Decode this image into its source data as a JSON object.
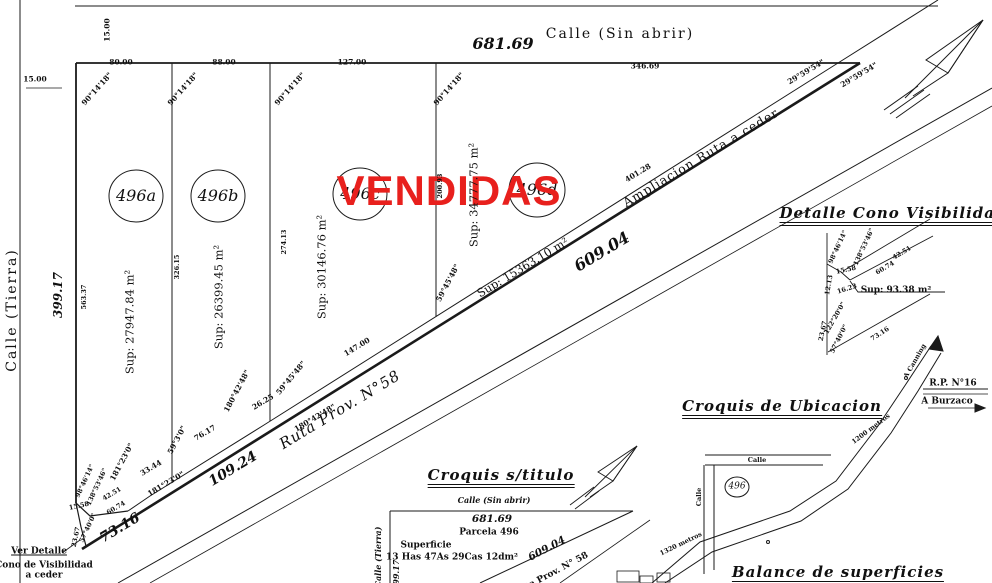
{
  "stamp_color": "#e8201d",
  "line_color": "#1a1a1a",
  "labels": [
    {
      "n": "dim-street-width-vert",
      "t": "15.00",
      "x": 107,
      "y": 30,
      "r": -90,
      "c": "dim"
    },
    {
      "n": "dim-street-width-left",
      "t": "15.00",
      "x": 35,
      "y": 79,
      "r": 0,
      "c": "dim"
    },
    {
      "n": "dim-frontage-496a",
      "t": "80.00",
      "x": 121,
      "y": 62,
      "r": 0,
      "c": "dim"
    },
    {
      "n": "angle-496a",
      "t": "90°14'18\"",
      "x": 97,
      "y": 89,
      "r": -48,
      "c": "dim"
    },
    {
      "n": "dim-frontage-496b",
      "t": "88.00",
      "x": 224,
      "y": 62,
      "r": 0,
      "c": "dim"
    },
    {
      "n": "angle-496b",
      "t": "90°14'18\"",
      "x": 183,
      "y": 89,
      "r": -48,
      "c": "dim"
    },
    {
      "n": "dim-frontage-496c",
      "t": "127.00",
      "x": 352,
      "y": 62,
      "r": 0,
      "c": "dim"
    },
    {
      "n": "angle-496c",
      "t": "90°14'18\"",
      "x": 290,
      "y": 89,
      "r": -48,
      "c": "dim"
    },
    {
      "n": "angle-496d",
      "t": "90°14'18\"",
      "x": 449,
      "y": 89,
      "r": -48,
      "c": "dim"
    },
    {
      "n": "dim-frontage-496d",
      "t": "346.69",
      "x": 645,
      "y": 66,
      "r": 0,
      "c": "dim"
    },
    {
      "n": "dim-street-total",
      "t": "681.69",
      "x": 503,
      "y": 44,
      "r": 0,
      "c": "numlg"
    },
    {
      "n": "street-name-top",
      "t": "Calle (Sin abrir)",
      "x": 620,
      "y": 34,
      "r": 0,
      "c": "street"
    },
    {
      "n": "angle-route-1",
      "t": "29°59'54\"",
      "x": 806,
      "y": 72,
      "r": -31,
      "c": "dim"
    },
    {
      "n": "angle-route-2",
      "t": "29°59'54\"",
      "x": 859,
      "y": 75,
      "r": -31,
      "c": "dim"
    },
    {
      "n": "street-name-left",
      "t": "Calle (Tierra)",
      "x": 12,
      "y": 310,
      "r": -90,
      "c": "street"
    },
    {
      "n": "dim-left-total",
      "t": "399.17",
      "x": 58,
      "y": 295,
      "r": -90,
      "c": "numsm"
    },
    {
      "n": "parcel-id-496a",
      "t": "496a",
      "x": 136,
      "y": 196,
      "r": 0,
      "c": "parcel"
    },
    {
      "n": "parcel-id-496b",
      "t": "496b",
      "x": 218,
      "y": 196,
      "r": 0,
      "c": "parcel"
    },
    {
      "n": "parcel-id-496c",
      "t": "496c",
      "x": 360,
      "y": 194,
      "r": 0,
      "c": "parcel"
    },
    {
      "n": "parcel-id-496d",
      "t": "496d",
      "x": 537,
      "y": 190,
      "r": 0,
      "c": "parcel"
    },
    {
      "n": "sold-stamp",
      "t": "VENDIDAS",
      "x": 449,
      "y": 191,
      "r": 0,
      "c": "stamp"
    },
    {
      "n": "dim-west-side",
      "t": "563.37",
      "x": 84,
      "y": 297,
      "r": -90,
      "c": "dimsm"
    },
    {
      "n": "area-496a",
      "t": "Sup: 27947.84 m²",
      "x": 130,
      "y": 322,
      "r": -90,
      "c": "sup"
    },
    {
      "n": "dim-div-ab",
      "t": "326.15",
      "x": 177,
      "y": 267,
      "r": -90,
      "c": "dimsm"
    },
    {
      "n": "area-496b",
      "t": "Sup: 26399.45 m²",
      "x": 219,
      "y": 297,
      "r": -90,
      "c": "sup"
    },
    {
      "n": "dim-div-bc",
      "t": "274.13",
      "x": 284,
      "y": 242,
      "r": -90,
      "c": "dimsm"
    },
    {
      "n": "area-496c",
      "t": "Sup: 30146.76 m²",
      "x": 322,
      "y": 267,
      "r": -90,
      "c": "sup"
    },
    {
      "n": "dim-div-cd",
      "t": "200.93",
      "x": 440,
      "y": 186,
      "r": -90,
      "c": "dimsm"
    },
    {
      "n": "area-496d",
      "t": "Sup: 34777.75 m²",
      "x": 474,
      "y": 195,
      "r": -90,
      "c": "sup"
    },
    {
      "n": "angle-div-cd",
      "t": "59°45'48\"",
      "x": 448,
      "y": 283,
      "r": -62,
      "c": "dim"
    },
    {
      "n": "angle-div-bc",
      "t": "59°45'48\"",
      "x": 291,
      "y": 378,
      "r": -50,
      "c": "dim"
    },
    {
      "n": "dim-diag-496d",
      "t": "401.28",
      "x": 638,
      "y": 173,
      "r": -31,
      "c": "dim"
    },
    {
      "n": "strip-name",
      "t": "Ampliacion Ruta a ceder",
      "x": 701,
      "y": 158,
      "r": -31,
      "c": "strip"
    },
    {
      "n": "area-strip",
      "t": "Sup: 15363.10 m²",
      "x": 523,
      "y": 268,
      "r": -31,
      "c": "sup"
    },
    {
      "n": "dim-route-edge",
      "t": "609.04",
      "x": 602,
      "y": 252,
      "r": -31,
      "c": "numlg"
    },
    {
      "n": "dim-diag-496c",
      "t": "147.00",
      "x": 357,
      "y": 347,
      "r": -31,
      "c": "dim"
    },
    {
      "n": "angle-bend-1",
      "t": "180°42'48\"",
      "x": 237,
      "y": 391,
      "r": -62,
      "c": "dim"
    },
    {
      "n": "dim-bend-seg",
      "t": "26.25",
      "x": 263,
      "y": 402,
      "r": -31,
      "c": "dim"
    },
    {
      "n": "angle-bend-2",
      "t": "180°42'48\"",
      "x": 315,
      "y": 418,
      "r": -31,
      "c": "dim"
    },
    {
      "n": "dim-diag-496b",
      "t": "76.17",
      "x": 205,
      "y": 433,
      "r": -31,
      "c": "dim"
    },
    {
      "n": "angle-div-ab-bottom",
      "t": "59°3'0\"",
      "x": 177,
      "y": 440,
      "r": -62,
      "c": "dim"
    },
    {
      "n": "dim-diag-496a",
      "t": "33.44",
      "x": 151,
      "y": 468,
      "r": -31,
      "c": "dim"
    },
    {
      "n": "angle-bend-3",
      "t": "181°23'0\"",
      "x": 122,
      "y": 462,
      "r": -62,
      "c": "dim"
    },
    {
      "n": "angle-bend-4",
      "t": "181°23'0\"",
      "x": 166,
      "y": 484,
      "r": -31,
      "c": "dim"
    },
    {
      "n": "dim-route-seg-2",
      "t": "109.24",
      "x": 233,
      "y": 469,
      "r": -31,
      "c": "nummd"
    },
    {
      "n": "route-name",
      "t": "Ruta Prov. N°58",
      "x": 340,
      "y": 410,
      "r": -31,
      "c": "route"
    },
    {
      "n": "dim-route-seg-1",
      "t": "73.16",
      "x": 120,
      "y": 528,
      "r": -31,
      "c": "nummd"
    },
    {
      "n": "cono-angle-1",
      "t": "98°46'14\"",
      "x": 85,
      "y": 481,
      "r": -65,
      "c": "dimsm"
    },
    {
      "n": "cono-angle-2",
      "t": "138°53'46\"",
      "x": 97,
      "y": 487,
      "r": -65,
      "c": "dimsm"
    },
    {
      "n": "cono-dim-1",
      "t": "15.58",
      "x": 79,
      "y": 506,
      "r": -12,
      "c": "dimsm"
    },
    {
      "n": "cono-dim-2",
      "t": "42.51",
      "x": 112,
      "y": 494,
      "r": -31,
      "c": "dimsm"
    },
    {
      "n": "cono-dim-3",
      "t": "60.74",
      "x": 116,
      "y": 508,
      "r": -31,
      "c": "dimsm"
    },
    {
      "n": "cono-angle-3",
      "t": "57°40'0\"",
      "x": 88,
      "y": 528,
      "r": -65,
      "c": "dimsm"
    },
    {
      "n": "cono-dim-4",
      "t": "23.67",
      "x": 76,
      "y": 537,
      "r": -78,
      "c": "dimsm"
    },
    {
      "n": "ver-detalle-line-1",
      "t": "Ver Detalle",
      "x": 39,
      "y": 552,
      "r": 0,
      "c": "smallbu"
    },
    {
      "n": "ver-detalle-line-2",
      "t": "Cono de Visibilidad",
      "x": 44,
      "y": 566,
      "r": 0,
      "c": "smallb"
    },
    {
      "n": "ver-detalle-line-3",
      "t": "a ceder",
      "x": 44,
      "y": 576,
      "r": 0,
      "c": "smallb"
    },
    {
      "n": "detail-title",
      "t": "Detalle Cono Visibilidad",
      "x": 893,
      "y": 216,
      "r": 0,
      "c": "title"
    },
    {
      "n": "detail-angle-1",
      "t": "98°46'14\"",
      "x": 838,
      "y": 247,
      "r": -65,
      "c": "dimsm"
    },
    {
      "n": "detail-angle-2",
      "t": "138°53'46\"",
      "x": 864,
      "y": 247,
      "r": -65,
      "c": "dimsm"
    },
    {
      "n": "detail-dim-1",
      "t": "42.51",
      "x": 902,
      "y": 253,
      "r": -31,
      "c": "dimsm"
    },
    {
      "n": "detail-dim-2",
      "t": "15.58",
      "x": 846,
      "y": 270,
      "r": -12,
      "c": "dimsm"
    },
    {
      "n": "detail-dim-3",
      "t": "60.74",
      "x": 885,
      "y": 268,
      "r": -31,
      "c": "dimsm"
    },
    {
      "n": "detail-dim-4",
      "t": "12.13",
      "x": 829,
      "y": 285,
      "r": -80,
      "c": "dimsm"
    },
    {
      "n": "detail-dim-5",
      "t": "16.23",
      "x": 847,
      "y": 289,
      "r": -18,
      "c": "dimsm"
    },
    {
      "n": "detail-area",
      "t": "Sup: 93.38 m²",
      "x": 896,
      "y": 291,
      "r": 0,
      "c": "smallb"
    },
    {
      "n": "detail-angle-3",
      "t": "122°20'0\"",
      "x": 835,
      "y": 318,
      "r": -60,
      "c": "dimsm"
    },
    {
      "n": "detail-dim-6",
      "t": "23.67",
      "x": 823,
      "y": 331,
      "r": -78,
      "c": "dimsm"
    },
    {
      "n": "detail-angle-4",
      "t": "57°40'0\"",
      "x": 839,
      "y": 339,
      "r": -63,
      "c": "dimsm"
    },
    {
      "n": "detail-dim-7",
      "t": "73.16",
      "x": 880,
      "y": 334,
      "r": -33,
      "c": "dimsm"
    },
    {
      "n": "location-title",
      "t": "Croquis de Ubicacion",
      "x": 782,
      "y": 409,
      "r": 0,
      "c": "title"
    },
    {
      "n": "road-a-canning",
      "t": "A Canning",
      "x": 915,
      "y": 361,
      "r": -60,
      "c": "dimsm"
    },
    {
      "n": "road-rp16",
      "t": "R.P. N°16",
      "x": 953,
      "y": 384,
      "r": 0,
      "c": "smallb"
    },
    {
      "n": "road-a-burzaco",
      "t": "A Burzaco",
      "x": 947,
      "y": 402,
      "r": 0,
      "c": "smallb"
    },
    {
      "n": "dist-1200",
      "t": "1200 metros",
      "x": 871,
      "y": 429,
      "r": -37,
      "c": "dimsm"
    },
    {
      "n": "dist-1320",
      "t": "1320 metros",
      "x": 681,
      "y": 544,
      "r": -26,
      "c": "dimsm"
    },
    {
      "n": "calle-h-label",
      "t": "Calle",
      "x": 757,
      "y": 460,
      "r": 0,
      "c": "dimsm"
    },
    {
      "n": "calle-v-label",
      "t": "Calle",
      "x": 699,
      "y": 497,
      "r": -90,
      "c": "dimsm"
    },
    {
      "n": "location-parcel-id",
      "t": "496",
      "x": 737,
      "y": 487,
      "r": 0,
      "c": "parcelsm"
    },
    {
      "n": "sketch-title",
      "t": "Croquis s/titulo",
      "x": 501,
      "y": 478,
      "r": 0,
      "c": "title"
    },
    {
      "n": "sketch-street-top",
      "t": "Calle (Sin abrir)",
      "x": 494,
      "y": 500,
      "r": 0,
      "c": "smallbi"
    },
    {
      "n": "sketch-dim-top",
      "t": "681.69",
      "x": 492,
      "y": 519,
      "r": 0,
      "c": "numxs"
    },
    {
      "n": "sketch-parcel",
      "t": "Parcela 496",
      "x": 489,
      "y": 533,
      "r": 0,
      "c": "smallb"
    },
    {
      "n": "sketch-sup-word",
      "t": "Superficie",
      "x": 426,
      "y": 546,
      "r": 0,
      "c": "smallb"
    },
    {
      "n": "sketch-sup-value",
      "t": "13 Has 47As 29Cas 12dm²",
      "x": 452,
      "y": 558,
      "r": 0,
      "c": "smallb"
    },
    {
      "n": "sketch-dim-diag",
      "t": "609.04",
      "x": 547,
      "y": 549,
      "r": -28,
      "c": "numxs"
    },
    {
      "n": "sketch-route-name",
      "t": "Ruta Prov. N° 58",
      "x": 551,
      "y": 575,
      "r": -28,
      "c": "smallb"
    },
    {
      "n": "sketch-street-left",
      "t": "Calle (Tierra)",
      "x": 378,
      "y": 557,
      "r": -90,
      "c": "smallbi"
    },
    {
      "n": "sketch-dim-left",
      "t": "399.17",
      "x": 396,
      "y": 575,
      "r": -90,
      "c": "smallbi"
    },
    {
      "n": "balance-title",
      "t": "Balance de superficies",
      "x": 838,
      "y": 575,
      "r": 0,
      "c": "title"
    }
  ]
}
